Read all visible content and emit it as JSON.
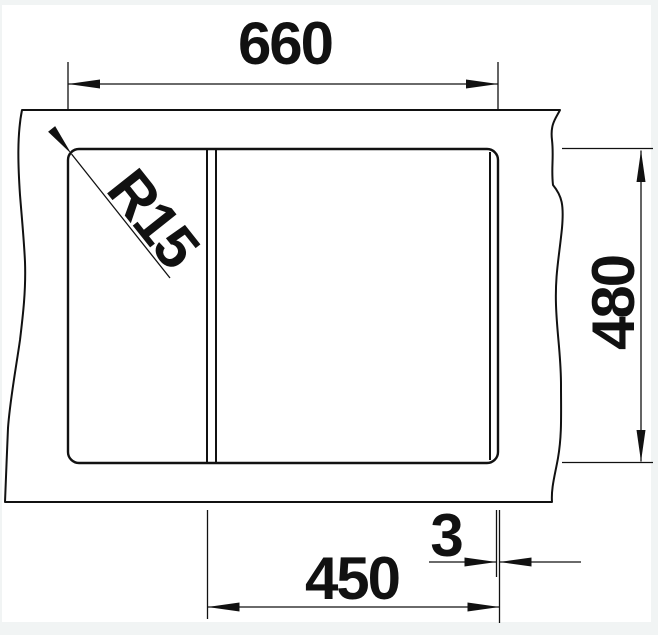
{
  "drawing": {
    "kind": "sink-cutout-dimension-drawing",
    "labels": {
      "cutout_width": "660",
      "cutout_depth": "480",
      "bowl_width": "450",
      "edge_offset": "3",
      "corner_radius": "R15"
    },
    "colors": {
      "line": "#111111",
      "paper": "#ffffff",
      "margin": "#f1f4f4"
    }
  }
}
